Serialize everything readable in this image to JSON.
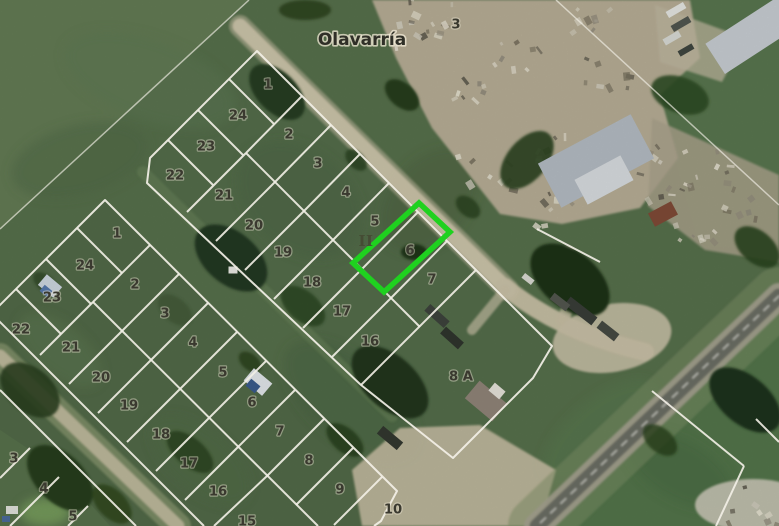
{
  "map": {
    "street_name": "Olavarría",
    "section_numeral": "II",
    "top_right_block_number": "3",
    "special_parcel_label": "8 A",
    "highlighted_lot": {
      "number": "6",
      "outline_color": "#1fd11f"
    },
    "colors": {
      "parcel_line": "#f3f0e7",
      "label": "#3a392f",
      "highlight": "#1fd11f",
      "dirt_road": "#cdc5ab",
      "asphalt": "#6b6d64",
      "field_base": "#566f4b"
    },
    "blocks": [
      {
        "name": "middle-block",
        "labels": [
          [
            "1",
            268,
            85
          ],
          [
            "24",
            238,
            116
          ],
          [
            "2",
            289,
            135
          ],
          [
            "23",
            206,
            147
          ],
          [
            "3",
            318,
            164
          ],
          [
            "22",
            175,
            176
          ],
          [
            "4",
            346,
            193
          ],
          [
            "21",
            224,
            196
          ],
          [
            "5",
            375,
            222
          ],
          [
            "20",
            254,
            226
          ],
          [
            "6",
            410,
            251
          ],
          [
            "19",
            283,
            253
          ],
          [
            "7",
            432,
            280
          ],
          [
            "18",
            312,
            283
          ],
          [
            "17",
            342,
            312
          ],
          [
            "16",
            370,
            342
          ]
        ]
      },
      {
        "name": "left-block",
        "labels": [
          [
            "1",
            117,
            234
          ],
          [
            "24",
            85,
            266
          ],
          [
            "2",
            135,
            285
          ],
          [
            "23",
            52,
            298
          ],
          [
            "3",
            165,
            314
          ],
          [
            "22",
            21,
            330
          ],
          [
            "4",
            193,
            343
          ],
          [
            "21",
            71,
            348
          ],
          [
            "5",
            223,
            373
          ],
          [
            "20",
            101,
            378
          ],
          [
            "6",
            252,
            403
          ],
          [
            "19",
            129,
            406
          ],
          [
            "7",
            280,
            432
          ],
          [
            "18",
            161,
            435
          ],
          [
            "8",
            309,
            461
          ],
          [
            "17",
            189,
            464
          ],
          [
            "9",
            340,
            490
          ],
          [
            "16",
            218,
            492
          ],
          [
            "10",
            393,
            510
          ],
          [
            "15",
            247,
            522
          ]
        ]
      },
      {
        "name": "bottom-left-block",
        "labels": [
          [
            "3",
            14,
            459
          ],
          [
            "4",
            44,
            489
          ],
          [
            "5",
            73,
            517
          ]
        ]
      },
      {
        "name": "top-right-block",
        "labels": [
          [
            "3",
            456,
            25
          ]
        ]
      }
    ],
    "geometry": {
      "green_polygon": "419,203 450,232 384,292 353,263",
      "outlines": [
        "M257,51 L476,270 L552,346 L533,378 L453,458 L361,385 L147,183 L150,158 Z",
        "M-7,312 L105,200 L397,491 L381,521 L374,526"
      ],
      "segments": [
        [
          246,
          153,
          420,
          327
        ],
        [
          302,
          96,
          246,
          153
        ],
        [
          331,
          125,
          275,
          182
        ],
        [
          360,
          154,
          304,
          211
        ],
        [
          389,
          183,
          333,
          240
        ],
        [
          418,
          212,
          362,
          269
        ],
        [
          447,
          241,
          391,
          298
        ],
        [
          246,
          153,
          187,
          212
        ],
        [
          275,
          182,
          216,
          241
        ],
        [
          304,
          211,
          245,
          270
        ],
        [
          333,
          240,
          274,
          299
        ],
        [
          362,
          269,
          303,
          328
        ],
        [
          391,
          298,
          332,
          357
        ],
        [
          229,
          79,
          274,
          124
        ],
        [
          198,
          110,
          243,
          155
        ],
        [
          168,
          140,
          213,
          185
        ],
        [
          476,
          270,
          361,
          385
        ],
        [
          537,
          229,
          600,
          262
        ],
        [
          -2,
          320,
          204,
          526
        ],
        [
          93,
          302,
          318,
          526
        ],
        [
          150,
          245,
          93,
          302
        ],
        [
          179,
          274,
          122,
          331
        ],
        [
          208,
          303,
          151,
          360
        ],
        [
          237,
          332,
          180,
          389
        ],
        [
          266,
          361,
          209,
          418
        ],
        [
          295,
          390,
          238,
          447
        ],
        [
          324,
          419,
          267,
          476
        ],
        [
          353,
          448,
          296,
          505
        ],
        [
          382,
          477,
          334,
          525
        ],
        [
          93,
          302,
          40,
          355
        ],
        [
          122,
          331,
          69,
          384
        ],
        [
          151,
          360,
          98,
          413
        ],
        [
          180,
          389,
          127,
          442
        ],
        [
          209,
          418,
          156,
          471
        ],
        [
          238,
          447,
          185,
          500
        ],
        [
          267,
          476,
          214,
          526
        ],
        [
          77,
          228,
          122,
          273
        ],
        [
          46,
          259,
          91,
          304
        ],
        [
          16,
          289,
          61,
          334
        ],
        [
          0,
          390,
          136,
          526
        ],
        [
          30,
          448,
          0,
          478
        ],
        [
          59,
          477,
          10,
          526
        ],
        [
          88,
          506,
          68,
          526
        ],
        [
          652,
          391,
          744,
          466
        ],
        [
          744,
          466,
          716,
          526
        ],
        [
          756,
          419,
          779,
          442
        ]
      ],
      "faint_segments": [
        [
          0,
          229,
          249,
          0
        ],
        [
          556,
          0,
          779,
          205
        ]
      ],
      "zones": [
        {
          "poly": "0,0 248,0 0,230",
          "fill": "#647c55",
          "op": 0.85
        },
        {
          "poly": "690,0 779,0 779,245 700,248 658,98",
          "fill": "#5a7850",
          "op": 0.7
        },
        {
          "poly": "779,302 779,526 540,526",
          "fill": "#517549",
          "op": 0.75
        },
        {
          "poly": "0,430 60,470 110,526 0,526",
          "fill": "#6a8758",
          "op": 0.6
        },
        {
          "poly": "257,51 476,270 552,346 533,378 453,458 361,385 147,183 150,158",
          "fill": "#50694a",
          "op": 0.45
        },
        {
          "poly": "-7,312 105,200 397,491 374,526 -7,526",
          "fill": "#4b6343",
          "op": 0.5
        }
      ],
      "field_patches": [
        [
          150,
          80,
          90,
          40,
          20,
          "#5d7751",
          0.5
        ],
        [
          80,
          160,
          70,
          35,
          -15,
          "#4e6846",
          0.5
        ],
        [
          350,
          400,
          80,
          40,
          40,
          "#47603f",
          0.4
        ],
        [
          200,
          460,
          60,
          30,
          40,
          "#516c47",
          0.4
        ],
        [
          300,
          200,
          70,
          50,
          40,
          "#4a6342",
          0.35
        ],
        [
          600,
          430,
          70,
          30,
          -40,
          "#5a7c50",
          0.4
        ],
        [
          60,
          350,
          50,
          25,
          40,
          "#5f7a52",
          0.45
        ],
        [
          430,
          200,
          40,
          60,
          40,
          "#445d3d",
          0.3
        ],
        [
          680,
          470,
          60,
          30,
          30,
          "#46653f",
          0.35
        ],
        [
          45,
          512,
          25,
          14,
          0,
          "#7ba35f",
          0.8
        ]
      ],
      "scrapyard": [
        {
          "poly": "372,0 690,0 700,58 660,95 678,158 640,208 562,224 500,214 432,128 396,58",
          "fill": "#b5ac94",
          "op": 1
        },
        {
          "poly": "652,118 779,175 779,262 705,250 648,206",
          "fill": "#a9a18b",
          "op": 0.85
        },
        {
          "poly": "655,5 745,38 722,82 660,62",
          "fill": "#bdb59d",
          "op": 0.75
        }
      ],
      "piles": [
        [
          753,
          505,
          58,
          26,
          "#c9c5b6",
          0.9
        ]
      ],
      "speckle_clusters": [
        [
          420,
          40
        ],
        [
          468,
          92
        ],
        [
          515,
          48
        ],
        [
          558,
          148
        ],
        [
          608,
          72
        ],
        [
          640,
          142
        ],
        [
          484,
          172
        ],
        [
          432,
          16
        ],
        [
          660,
          186
        ],
        [
          560,
          205
        ],
        [
          588,
          22
        ],
        [
          700,
          238
        ],
        [
          753,
          505
        ],
        [
          708,
          165
        ],
        [
          740,
          200
        ]
      ],
      "speckle_colors": [
        "#e3dfcf",
        "#8f897a",
        "#ddd8c8",
        "#5f5a4e",
        "#cfcabb",
        "#78715f"
      ],
      "roads": [
        {
          "d": "M143,172 L392,416",
          "stroke": "#69835a",
          "w": 12,
          "op": 0.55
        },
        {
          "d": "M0,356 L178,526",
          "stroke": "#95a078",
          "w": 26,
          "op": 0.6
        },
        {
          "d": "M0,356 L178,526",
          "stroke": "#c3bca0",
          "w": 13,
          "op": 0.9
        },
        {
          "d": "M240,26 L508,290",
          "stroke": "#c0b89e",
          "w": 22,
          "op": 0.55
        },
        {
          "d": "M240,26 L508,290",
          "stroke": "#cdc5ab",
          "w": 15,
          "op": 0.95
        },
        {
          "d": "M505,287 Q560,332 645,352",
          "stroke": "#c9c1a7",
          "w": 18,
          "op": 0.95
        },
        {
          "d": "M563,320 Q577,288 568,252",
          "stroke": "#c5bda3",
          "w": 12,
          "op": 0.8
        },
        {
          "d": "M505,290 L472,330",
          "stroke": "#c6bea4",
          "w": 10,
          "op": 0.7
        },
        {
          "poly": "352,470 400,428 480,425 556,470 540,526 362,526",
          "fill": "#c2ba9f",
          "op": 0.92
        },
        {
          "ellipse": [
            612,
            338,
            60,
            34,
            -10
          ],
          "fill": "#c6bfa5",
          "op": 0.9
        },
        {
          "d": "M779,296 L537,526",
          "stroke": "#7d9065",
          "w": 58,
          "op": 0.5
        },
        {
          "d": "M779,296 L537,526",
          "stroke": "#a3a18e",
          "w": 26,
          "op": 0.95
        },
        {
          "d": "M779,296 L537,526",
          "stroke": "#6b6d64",
          "w": 15,
          "op": 1
        },
        {
          "d": "M779,296 L537,526",
          "stroke": "#e8e8e0",
          "w": 1.3,
          "op": 0.8,
          "dash": "7 7"
        }
      ],
      "trees": [
        [
          277,
          92,
          34,
          20,
          45,
          "#263d20",
          1
        ],
        [
          402,
          95,
          20,
          12,
          40,
          "#273d1f",
          1
        ],
        [
          305,
          10,
          26,
          10,
          0,
          "#2c431e",
          0.9
        ],
        [
          231,
          258,
          42,
          26,
          40,
          "#223820",
          1
        ],
        [
          303,
          306,
          26,
          15,
          40,
          "#2f4826",
          0.9
        ],
        [
          356,
          160,
          13,
          8,
          45,
          "#2e4624",
          0.9
        ],
        [
          414,
          252,
          13,
          8,
          0,
          "#1f3319",
          0.95
        ],
        [
          390,
          382,
          46,
          26,
          42,
          "#20351c",
          1
        ],
        [
          345,
          440,
          22,
          12,
          40,
          "#2a411f",
          0.9
        ],
        [
          570,
          280,
          46,
          28,
          40,
          "#1d3118",
          1
        ],
        [
          527,
          160,
          20,
          34,
          40,
          "#27401f",
          0.9
        ],
        [
          468,
          207,
          14,
          9,
          40,
          "#2a431f",
          0.85
        ],
        [
          60,
          478,
          40,
          24,
          45,
          "#283d1e",
          1
        ],
        [
          112,
          504,
          24,
          14,
          45,
          "#31491f",
          0.9
        ],
        [
          30,
          390,
          34,
          22,
          40,
          "#2a3f20",
          0.9
        ],
        [
          190,
          452,
          28,
          14,
          40,
          "#2c421f",
          0.85
        ],
        [
          250,
          362,
          13,
          8,
          40,
          "#2c431e",
          0.9
        ],
        [
          680,
          95,
          30,
          18,
          20,
          "#2f4a24",
          0.9
        ],
        [
          757,
          247,
          26,
          16,
          40,
          "#2a421f",
          0.9
        ],
        [
          745,
          400,
          42,
          24,
          40,
          "#1f331a",
          1
        ],
        [
          660,
          440,
          20,
          12,
          40,
          "#264019",
          0.8
        ],
        [
          175,
          310,
          20,
          12,
          40,
          "#3a5330",
          0.6
        ],
        [
          45,
          283,
          14,
          8,
          40,
          "#2f4726",
          0.8
        ]
      ],
      "buildings": [
        [
          755,
          33,
          95,
          36,
          -33,
          "#c5cbd0"
        ],
        [
          596,
          161,
          105,
          50,
          -28,
          "#b2bac1"
        ],
        [
          604,
          180,
          52,
          28,
          -28,
          "#d6dadd"
        ],
        [
          663,
          214,
          26,
          15,
          -28,
          "#7e4a36"
        ],
        [
          676,
          10,
          20,
          7,
          -30,
          "#e2e4df"
        ],
        [
          681,
          24,
          20,
          7,
          -30,
          "#50564f"
        ],
        [
          672,
          38,
          18,
          7,
          -30,
          "#d6d8d2"
        ],
        [
          686,
          50,
          16,
          6,
          -30,
          "#3f453f"
        ],
        [
          437,
          316,
          26,
          9,
          42,
          "#3d423c"
        ],
        [
          452,
          338,
          24,
          9,
          42,
          "#2f342d"
        ],
        [
          581,
          311,
          34,
          10,
          38,
          "#383d37"
        ],
        [
          608,
          331,
          22,
          9,
          38,
          "#454a42"
        ],
        [
          560,
          302,
          20,
          8,
          38,
          "#52564e"
        ],
        [
          528,
          279,
          12,
          6,
          38,
          "#d8d8d0"
        ],
        [
          390,
          438,
          26,
          10,
          40,
          "#32372f"
        ],
        [
          486,
          401,
          36,
          23,
          40,
          "#8e8377"
        ],
        [
          497,
          391,
          14,
          10,
          40,
          "#e3e0d8"
        ],
        [
          50,
          286,
          20,
          14,
          40,
          "#ccd5de"
        ],
        [
          46,
          291,
          10,
          8,
          40,
          "#5577aa"
        ],
        [
          258,
          382,
          24,
          16,
          40,
          "#e0e4e9"
        ],
        [
          253,
          386,
          12,
          9,
          40,
          "#3a5a8c"
        ],
        [
          233,
          270,
          9,
          7,
          0,
          "#e8e8e2"
        ],
        [
          12,
          510,
          12,
          8,
          0,
          "#dfe0da"
        ],
        [
          6,
          519,
          8,
          6,
          0,
          "#4a6a9a"
        ]
      ],
      "label_positions": {
        "street": [
          362,
          40
        ],
        "numeral": [
          366,
          241
        ],
        "special_parcel": [
          461,
          377
        ]
      }
    }
  }
}
